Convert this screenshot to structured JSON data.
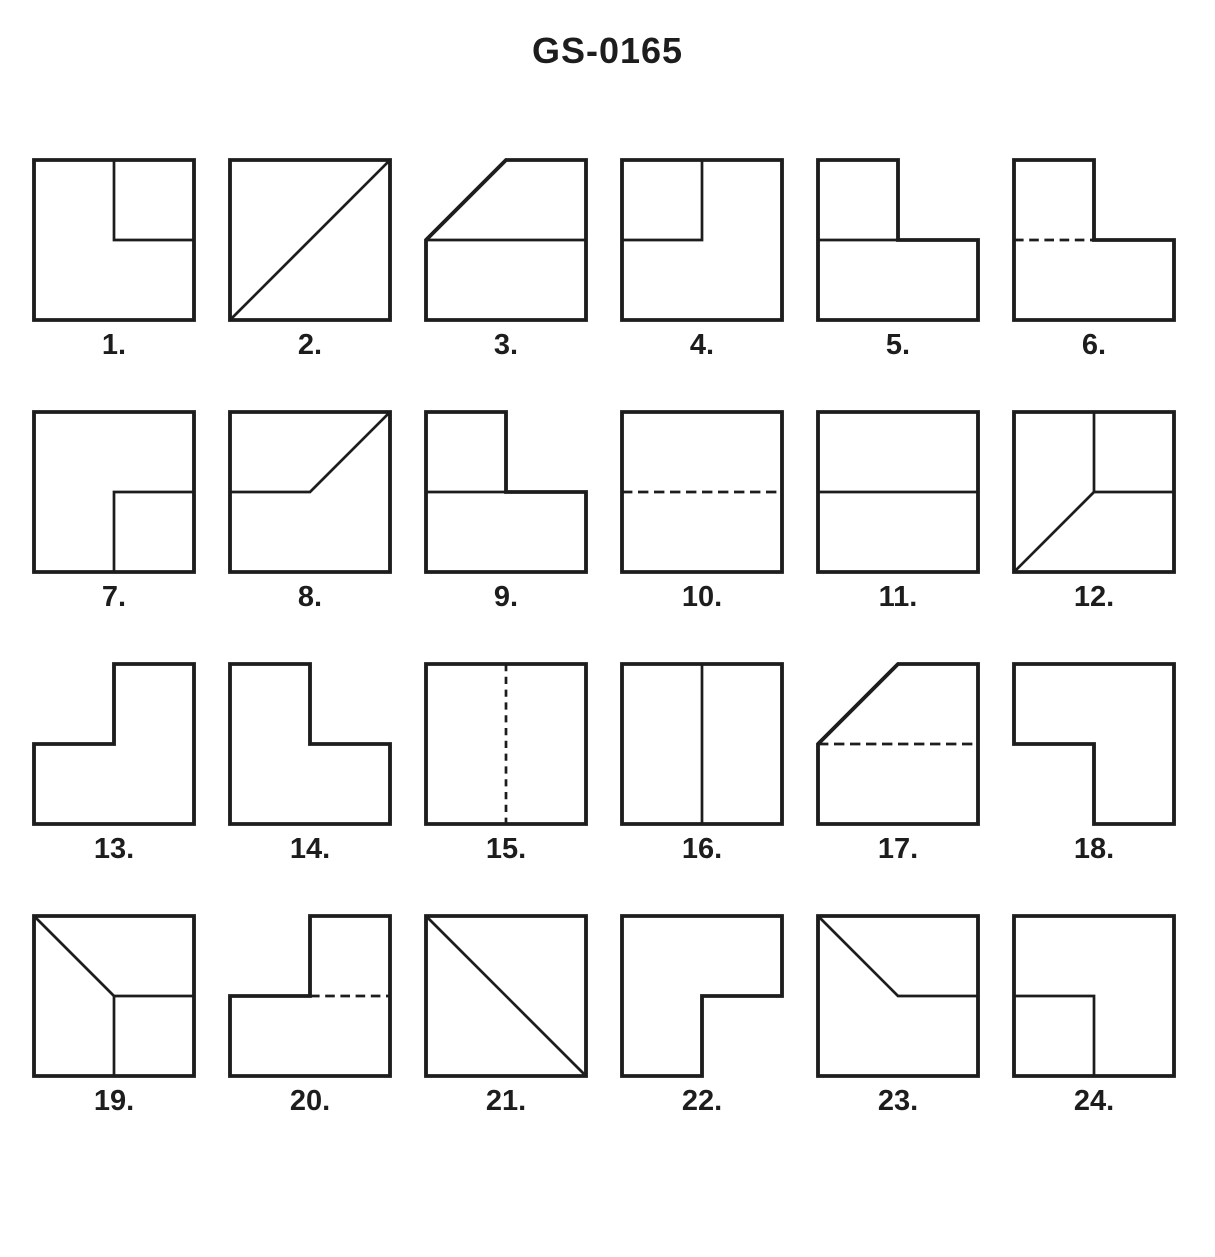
{
  "title": "GS-0165",
  "colors": {
    "ink": "#1d1d1d",
    "paper": "#ffffff"
  },
  "figures": [
    {
      "label": "1.",
      "outline": "0,0 100,0 100,100 0,100",
      "lines": [
        {
          "pts": "50,0 50,50 100,50"
        }
      ]
    },
    {
      "label": "2.",
      "outline": "0,0 100,0 100,100 0,100",
      "lines": [
        {
          "pts": "0,100 100,0"
        }
      ]
    },
    {
      "label": "3.",
      "outline": "0,50 50,0 100,0 100,100 0,100",
      "lines": [
        {
          "pts": "0,50 100,50"
        }
      ]
    },
    {
      "label": "4.",
      "outline": "0,0 100,0 100,100 0,100",
      "lines": [
        {
          "pts": "50,0 50,50 0,50"
        }
      ]
    },
    {
      "label": "5.",
      "outline": "0,0 50,0 50,50 100,50 100,100 0,100",
      "lines": [
        {
          "pts": "0,50 50,50"
        }
      ]
    },
    {
      "label": "6.",
      "outline": "0,0 50,0 50,50 100,50 100,100 0,100",
      "lines": [
        {
          "pts": "0,50 50,50",
          "dash": "6 3.5"
        }
      ]
    },
    {
      "label": "7.",
      "outline": "0,0 100,0 100,100 0,100",
      "lines": [
        {
          "pts": "100,50 50,50 50,100"
        }
      ]
    },
    {
      "label": "8.",
      "outline": "0,0 100,0 100,100 0,100",
      "lines": [
        {
          "pts": "0,50 50,50 100,0"
        }
      ]
    },
    {
      "label": "9.",
      "outline": "0,0 50,0 50,50 100,50 100,100 0,100",
      "lines": [
        {
          "pts": "0,50 50,50"
        }
      ]
    },
    {
      "label": "10.",
      "outline": "0,0 100,0 100,100 0,100",
      "lines": [
        {
          "pts": "0,50 100,50",
          "dash": "6.5 3.5"
        }
      ]
    },
    {
      "label": "11.",
      "outline": "0,0 100,0 100,100 0,100",
      "lines": [
        {
          "pts": "0,50 100,50"
        }
      ]
    },
    {
      "label": "12.",
      "outline": "0,0 100,0 100,100 0,100",
      "lines": [
        {
          "pts": "50,0 50,50 100,50"
        },
        {
          "pts": "50,50 0,100"
        }
      ]
    },
    {
      "label": "13.",
      "outline": "50,0 100,0 100,100 0,100 0,50 50,50",
      "lines": []
    },
    {
      "label": "14.",
      "outline": "0,0 50,0 50,50 100,50 100,100 0,100",
      "lines": []
    },
    {
      "label": "15.",
      "outline": "0,0 100,0 100,100 0,100",
      "lines": [
        {
          "pts": "50,0 50,100",
          "dash": "4.5 3.5"
        }
      ]
    },
    {
      "label": "16.",
      "outline": "0,0 100,0 100,100 0,100",
      "lines": [
        {
          "pts": "50,0 50,100"
        }
      ]
    },
    {
      "label": "17.",
      "outline": "0,50 50,0 100,0 100,100 0,100",
      "lines": [
        {
          "pts": "0,50 100,50",
          "dash": "6.5 3.5"
        }
      ]
    },
    {
      "label": "18.",
      "outline": "0,0 100,0 100,100 50,100 50,50 0,50",
      "lines": []
    },
    {
      "label": "19.",
      "outline": "0,0 100,0 100,100 0,100",
      "lines": [
        {
          "pts": "0,0 50,50 100,50"
        },
        {
          "pts": "50,50 50,100"
        }
      ]
    },
    {
      "label": "20.",
      "outline": "50,0 100,0 100,100 0,100 0,50 50,50",
      "lines": [
        {
          "pts": "50,50 100,50",
          "dash": "6 3.5"
        }
      ]
    },
    {
      "label": "21.",
      "outline": "0,0 100,0 100,100 0,100",
      "lines": [
        {
          "pts": "0,0 100,100"
        }
      ]
    },
    {
      "label": "22.",
      "outline": "0,0 100,0 100,50 50,50 50,100 0,100",
      "lines": []
    },
    {
      "label": "23.",
      "outline": "0,0 100,0 100,100 0,100",
      "lines": [
        {
          "pts": "0,0 50,50 100,50"
        }
      ]
    },
    {
      "label": "24.",
      "outline": "0,0 100,0 100,100 0,100",
      "lines": [
        {
          "pts": "0,50 50,50 50,100"
        }
      ]
    }
  ]
}
